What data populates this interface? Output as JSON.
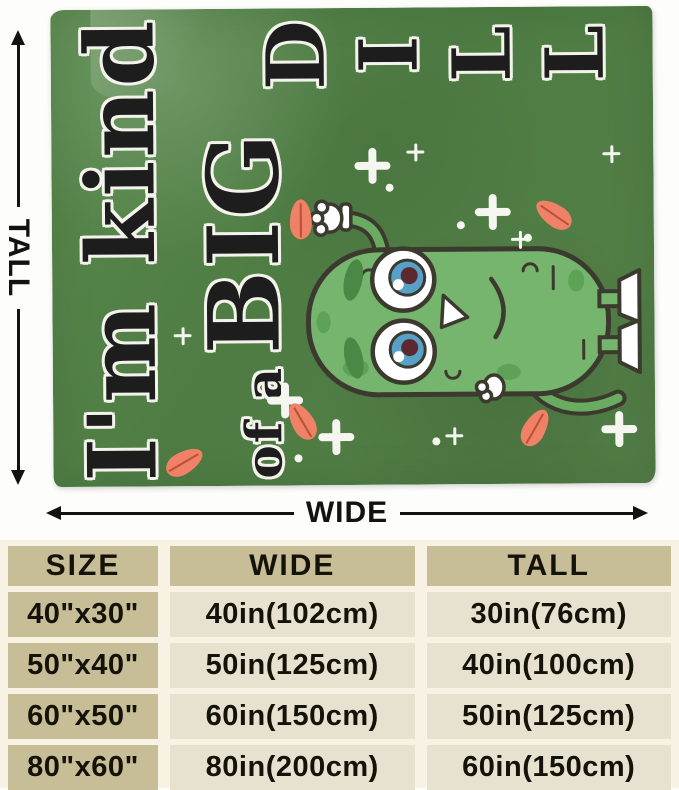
{
  "photo": {
    "tall_label": "TALL",
    "wide_label": "WIDE",
    "blanket_design": {
      "line1": "I'm kind",
      "line2_prefix": "of a",
      "line2_word": "BIG",
      "dill_letters": [
        "D",
        "I",
        "L",
        "L"
      ]
    },
    "colors": {
      "blanket_green": "#4e7c43",
      "design_text": "#1d1d1d",
      "design_outline": "#f3f3ec",
      "pickle_body": "#75b56d",
      "pickle_outline": "#3c392f",
      "leaf_salmon": "#ee8166",
      "eye_iris_blue": "#57a0c7"
    }
  },
  "size_chart": {
    "headers": [
      "SIZE",
      "WIDE",
      "TALL"
    ],
    "rows": [
      [
        "40\"x30\"",
        "40in(102cm)",
        "30in(76cm)"
      ],
      [
        "50\"x40\"",
        "50in(125cm)",
        "40in(100cm)"
      ],
      [
        "60\"x50\"",
        "60in(150cm)",
        "50in(125cm)"
      ],
      [
        "80\"x60\"",
        "80in(200cm)",
        "60in(150cm)"
      ]
    ],
    "colors": {
      "header_bg": "#c7bd96",
      "cell_bg": "#e7e2d0",
      "gap_bg": "#f8f2e4",
      "text": "#15120a"
    }
  },
  "chart_data": {
    "type": "table",
    "columns": [
      "SIZE",
      "WIDE",
      "TALL"
    ],
    "rows": [
      [
        "40\"x30\"",
        "40in(102cm)",
        "30in(76cm)"
      ],
      [
        "50\"x40\"",
        "50in(125cm)",
        "40in(100cm)"
      ],
      [
        "60\"x50\"",
        "60in(150cm)",
        "50in(125cm)"
      ],
      [
        "80\"x60\"",
        "80in(200cm)",
        "60in(150cm)"
      ]
    ]
  }
}
